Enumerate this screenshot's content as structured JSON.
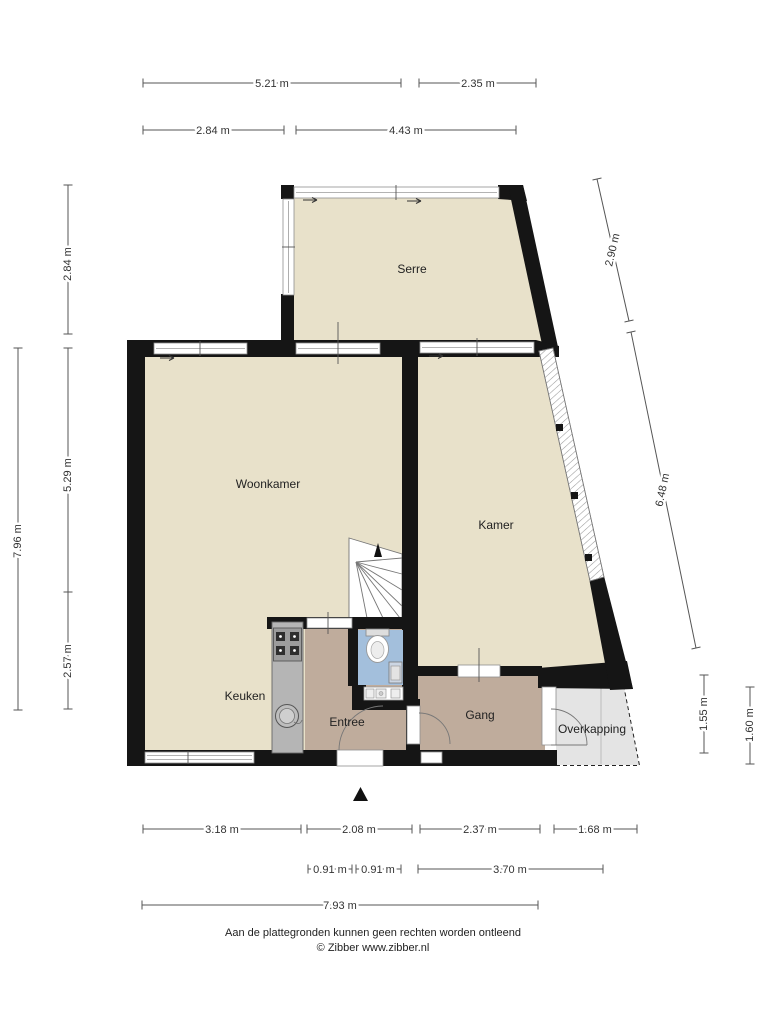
{
  "meta": {
    "width": 768,
    "height": 1024
  },
  "colors": {
    "floor": "#e8e1ca",
    "hallway": "#bfac9c",
    "toilet_floor": "#a3bfdc",
    "counter": "#b5b5b5",
    "canopy": "#e4e4e4",
    "wall": "#151515",
    "dimension_text": "#333333"
  },
  "rooms": [
    {
      "id": "serre",
      "label": "Serre"
    },
    {
      "id": "woonkamer",
      "label": "Woonkamer"
    },
    {
      "id": "kamer",
      "label": "Kamer"
    },
    {
      "id": "keuken",
      "label": "Keuken"
    },
    {
      "id": "entree",
      "label": "Entree"
    },
    {
      "id": "gang",
      "label": "Gang"
    },
    {
      "id": "overkapping",
      "label": "Overkapping"
    }
  ],
  "dimensions": {
    "top_row1": [
      {
        "label": "5.21 m"
      },
      {
        "label": "2.35 m"
      }
    ],
    "top_row2": [
      {
        "label": "2.84 m"
      },
      {
        "label": "4.43 m"
      }
    ],
    "left": [
      {
        "label": "2.84 m"
      },
      {
        "label": "5.29 m"
      },
      {
        "label": "7.96 m"
      },
      {
        "label": "2.57 m"
      }
    ],
    "right_diagonal": [
      {
        "label": "2.90 m"
      },
      {
        "label": "6.48 m"
      }
    ],
    "right_vertical": [
      {
        "label": "1.55 m"
      },
      {
        "label": "1.60 m"
      }
    ],
    "bottom_row1": [
      {
        "label": "3.18 m"
      },
      {
        "label": "2.08 m"
      },
      {
        "label": "2.37 m"
      },
      {
        "label": "1.68 m"
      }
    ],
    "bottom_row2": [
      {
        "label": "0.91 m"
      },
      {
        "label": "0.91 m"
      },
      {
        "label": "3.70 m"
      }
    ],
    "bottom_row3": [
      {
        "label": "7.93 m"
      }
    ]
  },
  "footer": {
    "disclaimer": "Aan de plattegronden kunnen geen rechten worden ontleend",
    "credit": "© Zibber www.zibber.nl"
  }
}
